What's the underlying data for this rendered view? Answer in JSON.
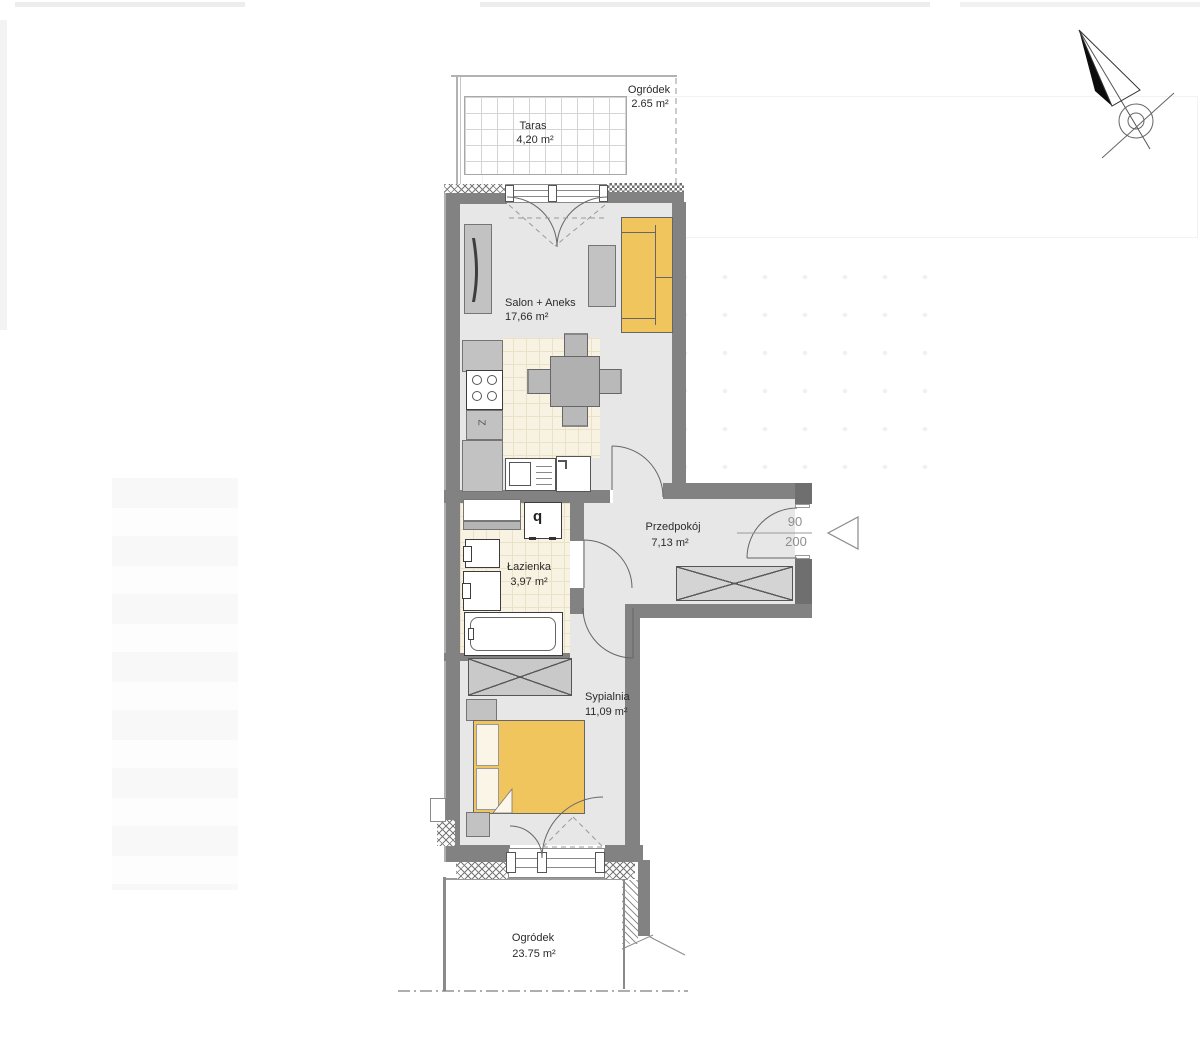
{
  "plan": {
    "title_context": "apartment-floor-plan",
    "rooms": {
      "taras": {
        "name": "Taras",
        "area": "4,20 m²"
      },
      "ogrodek_top": {
        "name": "Ogródek",
        "area": "2.65 m²"
      },
      "salon": {
        "name": "Salon + Aneks",
        "area": "17,66 m²"
      },
      "przedpokoj": {
        "name": "Przedpokój",
        "area": "7,13 m²"
      },
      "lazienka": {
        "name": "Łazienka",
        "area": "3,97 m²"
      },
      "sypialnia": {
        "name": "Sypialnia",
        "area": "11,09 m²"
      },
      "ogrodek_dol": {
        "name": "Ogródek",
        "area": "23.75 m²"
      }
    },
    "entrance_door": {
      "width_cm": "90",
      "height_cm": "200"
    },
    "symbols": {
      "washing_machine": "q",
      "fridge": "Z"
    },
    "colors": {
      "wall": "#828282",
      "wall_dark": "#6f6f6f",
      "floor": "#e7e7e7",
      "tile_floor": "#f8f2e2",
      "furniture_accent": "#f0c55e"
    }
  }
}
